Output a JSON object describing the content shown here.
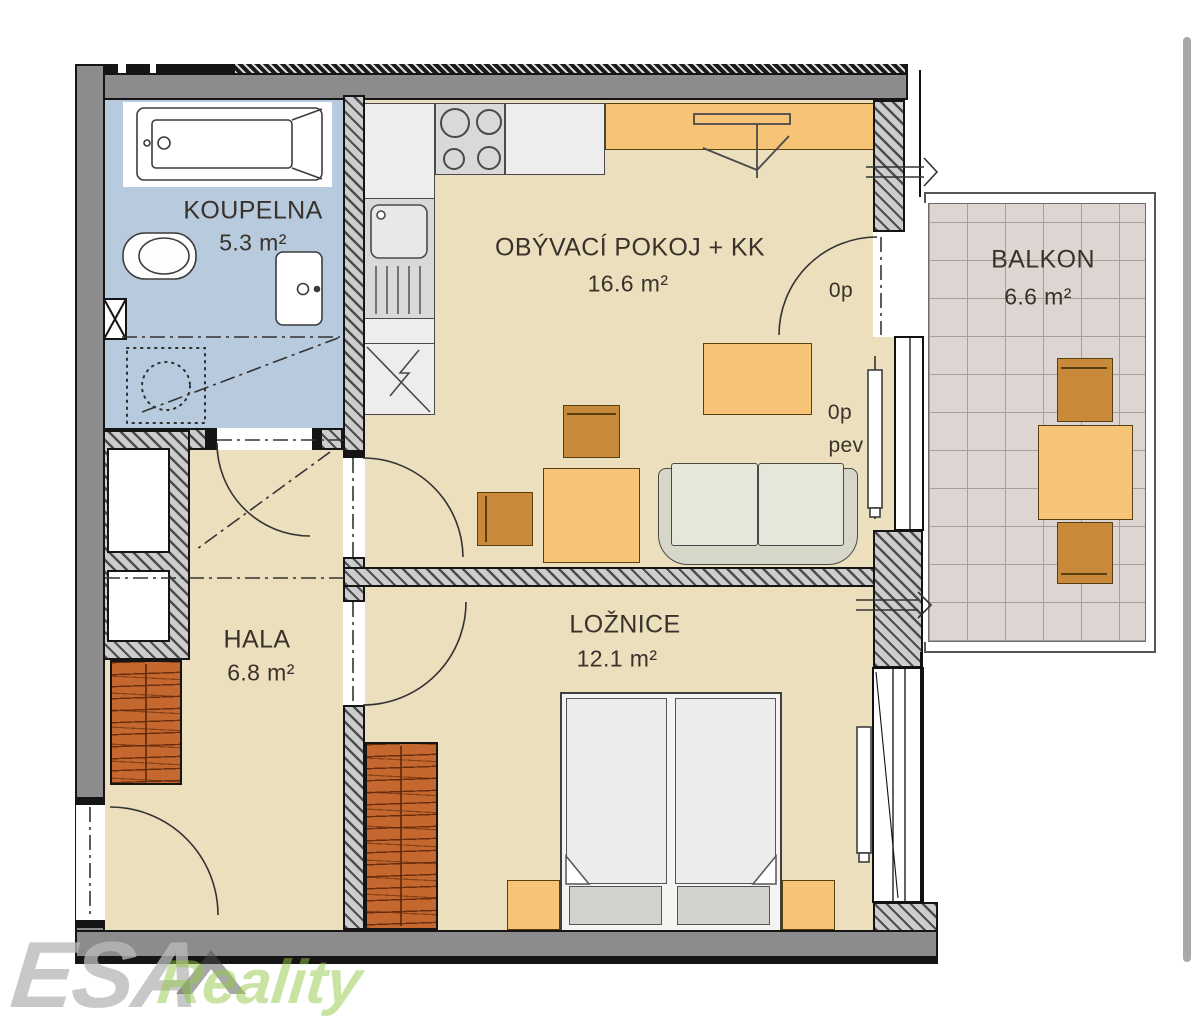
{
  "rooms": {
    "koupelna": {
      "name": "KOUPELNA",
      "area": "5.3 m²"
    },
    "obyvaci_pokoj": {
      "name": "OBÝVACÍ POKOJ + KK",
      "area": "16.6 m²"
    },
    "balkon": {
      "name": "BALKON",
      "area": "6.6 m²"
    },
    "hala": {
      "name": "HALA",
      "area": "6.8 m²"
    },
    "loznice": {
      "name": "LOŽNICE",
      "area": "12.1 m²"
    }
  },
  "annotations": {
    "balcony_door_parapet": "0p",
    "window_parapet": "0p",
    "window_fixed": "pev"
  },
  "watermark": {
    "brand": "ESA",
    "suffix": "Reality"
  },
  "colors": {
    "floor_main": "#ebdfbd",
    "floor_bathroom": "#b8cadd",
    "balcony_tile": "#ddd5d1",
    "wall_gray": "#8c8c8c",
    "furniture_light": "#f6c377",
    "furniture_dark": "#c9893b",
    "wardrobe_brown": "#c4682f",
    "watermark_gray": "#c6c6c6",
    "watermark_green": "#b7dc8e"
  }
}
